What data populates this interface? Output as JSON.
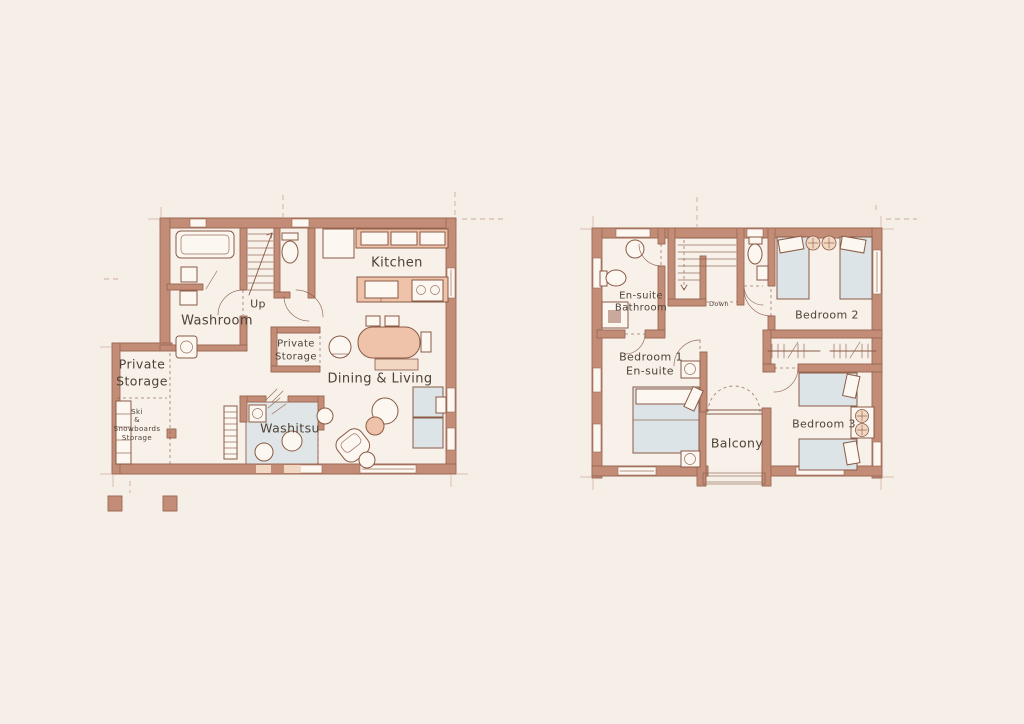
{
  "colors": {
    "background": "#f5efe8",
    "paper": "#fcf7f1",
    "room_fill": "#f7f1ea",
    "wall": "#c28c77",
    "wall_dark": "#9d6a55",
    "line": "#8a5a45",
    "furniture_salmon": "#eec3a9",
    "furniture_salmon_light": "#f2d7c2",
    "furniture_blue": "#dde4e7",
    "construction": "#c9a089",
    "text": "#4e4238"
  },
  "ground_floor": {
    "labels": {
      "kitchen": "Kitchen",
      "up": "Up",
      "washroom": "Washroom",
      "closet_storage_line1": "Private",
      "closet_storage_line2": "Storage",
      "dining_living": "Dining & Living",
      "washitsu": "Washitsu",
      "private_storage_line1": "Private",
      "private_storage_line2": "Storage",
      "ski_storage_line1": "Ski",
      "ski_storage_line2": "&",
      "ski_storage_line3": "Snowboards",
      "ski_storage_line4": "Storage"
    }
  },
  "upper_floor": {
    "labels": {
      "ensuite_bathroom_line1": "En-suite",
      "ensuite_bathroom_line2": "Bathroom",
      "down": "Down",
      "bedroom2": "Bedroom 2",
      "bedroom1_line1": "Bedroom 1",
      "bedroom1_line2": "En-suite",
      "balcony": "Balcony",
      "bedroom3": "Bedroom 3"
    }
  }
}
